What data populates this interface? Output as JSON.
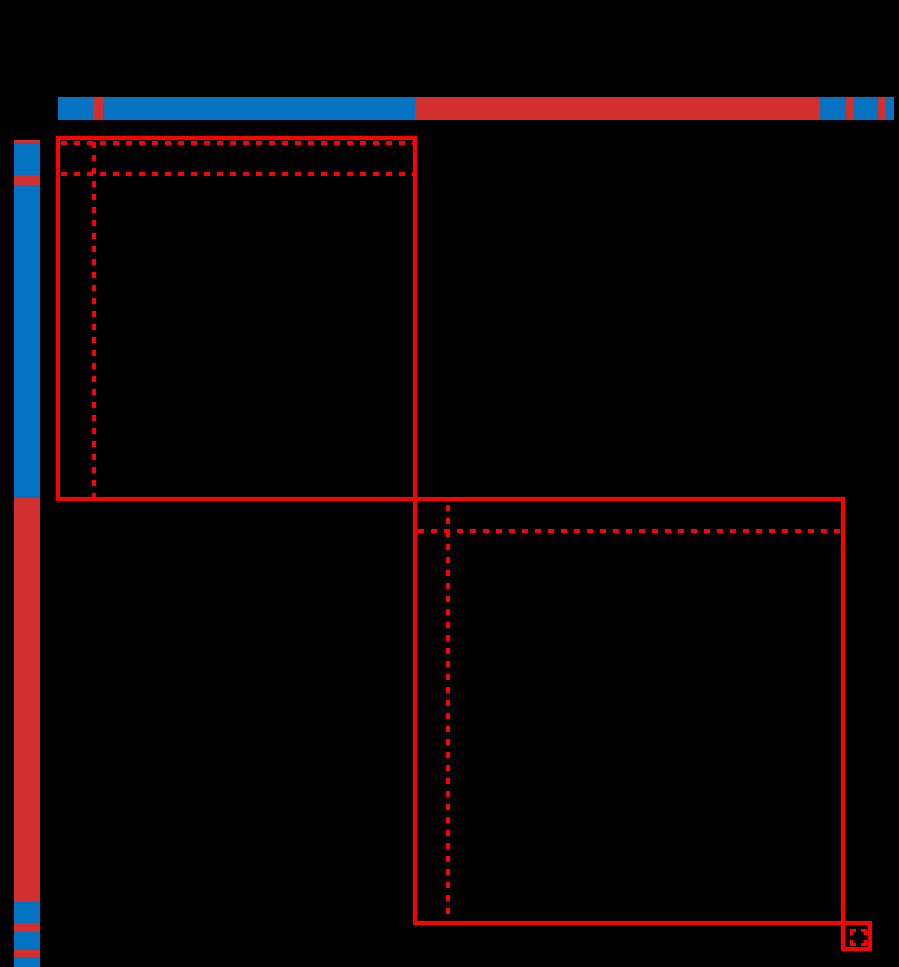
{
  "figure": {
    "width": 899,
    "height": 967,
    "background": "#000000",
    "description": "Rearranged data matrix on black background with row and column class-label bars (two classes: blue, red) and red boxes outlining three diagonal clusters"
  },
  "colors": {
    "class_blue": "#0473c1",
    "class_red": "#d32f2f",
    "cluster_outline_red": "#ff0000",
    "background_black": "#000000"
  },
  "chart_data": {
    "type": "heatmap",
    "title": "",
    "axis": "hidden",
    "grid": false,
    "legend": "none",
    "classes": [
      "blue",
      "red"
    ],
    "dash_pattern": {
      "dash": 6,
      "gap": 7,
      "thickness": 4
    },
    "line_thickness": 4,
    "column_label_bar": {
      "top": 97,
      "height": 23,
      "segments": [
        {
          "class": "blue",
          "from": 58,
          "to": 93
        },
        {
          "class": "red",
          "from": 93,
          "to": 103
        },
        {
          "class": "blue",
          "from": 103,
          "to": 415
        },
        {
          "class": "red",
          "from": 415,
          "to": 820
        },
        {
          "class": "blue",
          "from": 820,
          "to": 846
        },
        {
          "class": "red",
          "from": 846,
          "to": 854
        },
        {
          "class": "blue",
          "from": 854,
          "to": 878
        },
        {
          "class": "red",
          "from": 878,
          "to": 886
        },
        {
          "class": "blue",
          "from": 886,
          "to": 894
        }
      ]
    },
    "row_label_bar": {
      "left": 14,
      "width": 26,
      "segments": [
        {
          "class": "red",
          "from": 140,
          "to": 143
        },
        {
          "class": "blue",
          "from": 143,
          "to": 175
        },
        {
          "class": "red",
          "from": 175,
          "to": 185
        },
        {
          "class": "blue",
          "from": 185,
          "to": 498
        },
        {
          "class": "red",
          "from": 498,
          "to": 902
        },
        {
          "class": "blue",
          "from": 902,
          "to": 923
        },
        {
          "class": "red",
          "from": 923,
          "to": 932
        },
        {
          "class": "blue",
          "from": 932,
          "to": 950
        },
        {
          "class": "red",
          "from": 950,
          "to": 957
        },
        {
          "class": "blue",
          "from": 957,
          "to": 967
        }
      ]
    },
    "clusters": [
      {
        "id": "cluster-1",
        "left": 56,
        "top": 136,
        "right": 417,
        "bottom": 501
      },
      {
        "id": "cluster-2",
        "left": 413,
        "top": 497,
        "right": 845,
        "bottom": 925
      },
      {
        "id": "cluster-3",
        "left": 841,
        "top": 921,
        "right": 872,
        "bottom": 951
      }
    ],
    "dashed_lines": [
      {
        "id": "cluster-1-top-subline",
        "orientation": "horizontal",
        "x": 61,
        "y": 141,
        "length": 352
      },
      {
        "id": "cluster-1-row-subline",
        "orientation": "horizontal",
        "x": 61,
        "y": 172,
        "length": 352
      },
      {
        "id": "cluster-1-col-subline",
        "orientation": "vertical",
        "x": 92,
        "y": 142,
        "length": 355
      },
      {
        "id": "cluster-2-row-subline",
        "orientation": "horizontal",
        "x": 418,
        "y": 529,
        "length": 423
      },
      {
        "id": "cluster-2-col-subline",
        "orientation": "vertical",
        "x": 446,
        "y": 505,
        "length": 415
      }
    ],
    "dashed_boxes": [
      {
        "id": "cluster-3-inner",
        "left": 850,
        "top": 929,
        "width": 17,
        "height": 17,
        "border": 3
      }
    ]
  }
}
